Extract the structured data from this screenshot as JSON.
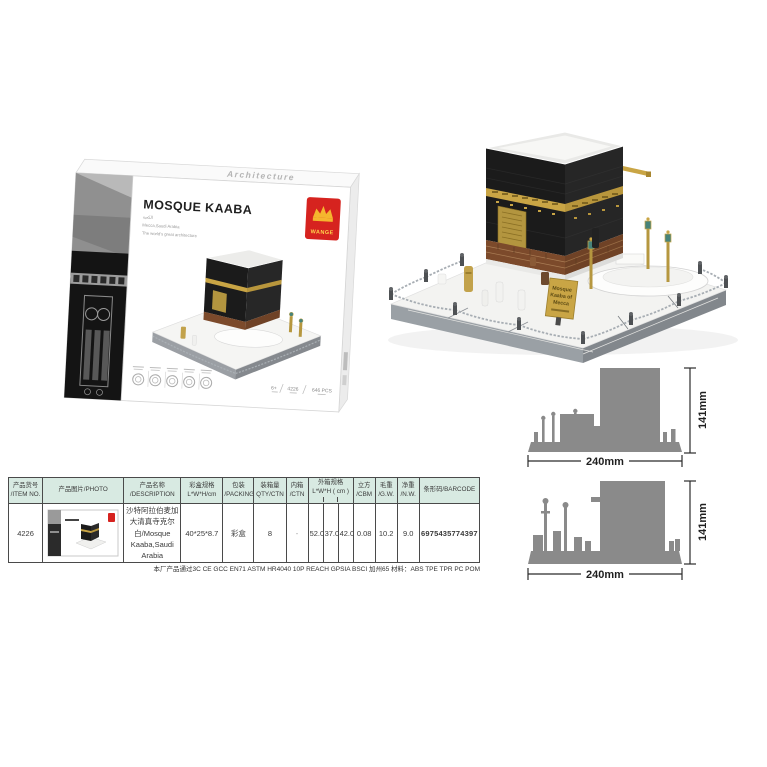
{
  "colors": {
    "header_bg": "#d8eae2",
    "silhouette_gray": "#8a8a8a",
    "gold": "#c9a545",
    "brand_red": "#d6231f",
    "kaaba_black": "#1b1b1b"
  },
  "box": {
    "edge_text": "Architecture",
    "brand": "WANGE",
    "title": "MOSQUE KAABA",
    "subtitle_lines": [
      "الكعبة",
      "Mecca,Saudi Arabia",
      "The world's great architecture"
    ],
    "age": "6+",
    "item_no": "4226",
    "pieces": "646 PCS"
  },
  "model": {
    "sign_lines": [
      "Mosque",
      "Kaaba of",
      "Mecca"
    ]
  },
  "dimensions": {
    "views": [
      {
        "height": "141mm",
        "width": "240mm"
      },
      {
        "height": "141mm",
        "width": "240mm"
      }
    ]
  },
  "table": {
    "headers": [
      {
        "line1": "产品货号",
        "line2": "/ITEM NO."
      },
      {
        "line1": "产品图片/PHOTO",
        "line2": ""
      },
      {
        "line1": "产品名称",
        "line2": "/DESCRIPTION"
      },
      {
        "line1": "彩盒规格",
        "line2": "L*W*H/cm"
      },
      {
        "line1": "包装",
        "line2": "/PACKING"
      },
      {
        "line1": "装箱量",
        "line2": "QTY/CTN"
      },
      {
        "line1": "内箱",
        "line2": "/CTN"
      },
      {
        "line1": "外箱规格",
        "line2": "L*W*H ( cm )"
      },
      {
        "line1": "立方",
        "line2": "/CBM"
      },
      {
        "line1": "毛重",
        "line2": "/G.W."
      },
      {
        "line1": "净重",
        "line2": "/N.W."
      },
      {
        "line1": "条形码/BARCODE",
        "line2": ""
      }
    ],
    "row": {
      "item_no": "4226",
      "description": "沙特阿拉伯麦加大清真寺克尔白/Mosque Kaaba,Saudi Arabia",
      "box_size": "40*25*8.7",
      "packing": "彩盒",
      "qty_ctn": "8",
      "inner_ctn": "-",
      "outer_l": "52.0",
      "outer_w": "37.0",
      "outer_h": "42.0",
      "cbm": "0.08",
      "gw": "10.2",
      "nw": "9.0",
      "barcode": "6975435774397"
    }
  },
  "footer_note": "本厂产品通过3C  CE  GCC  EN71  ASTM  HR4040 10P  REACH  GPSIA  BSCI  加州65   材料：ABS TPE TPR PC POM"
}
